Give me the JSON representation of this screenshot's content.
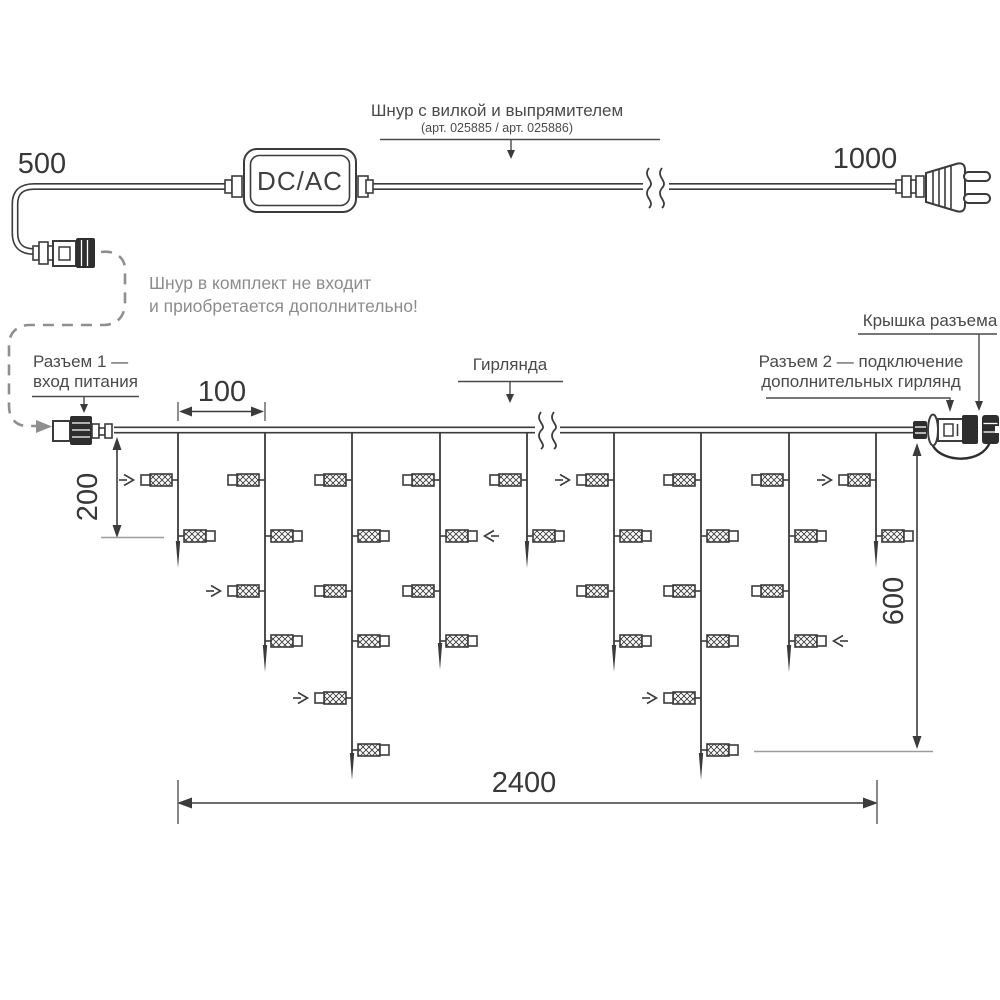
{
  "colors": {
    "ink": "#3b3b3b",
    "label_text": "#4a4a4a",
    "muted_text": "#8c8c8c",
    "dashed_line": "#8f8f8f",
    "reference_line": "#9c9c9c"
  },
  "power_cord": {
    "label_line1": "Шнур с вилкой и выпрямителем",
    "label_line2": "(арт. 025885 / арт. 025886)",
    "adapter_label": "DC/AC",
    "dim_left": "500",
    "dim_right": "1000",
    "note_line1": "Шнур в комплект не входит",
    "note_line2": "и приобретается дополнительно!"
  },
  "garland_labels": {
    "connector1_line1": "Разъем 1 —",
    "connector1_line2": "вход питания",
    "garland": "Гирлянда",
    "connector2_line1": "Разъем 2 — подключение",
    "connector2_line2": "дополнительных гирлянд",
    "cap": "Крышка разъема"
  },
  "dimensions": {
    "drop_spacing": "100",
    "first_drop": "200",
    "height": "600",
    "length": "2400"
  },
  "garland": {
    "wire_y": 430,
    "x_start": 114,
    "x_end": 915,
    "lamp_levels": [
      480,
      536,
      591,
      641,
      698,
      750
    ],
    "drops": [
      {
        "x": 178,
        "lamps": 2,
        "tip": 568,
        "arrow": {
          "level": 0,
          "side": "L"
        }
      },
      {
        "x": 265,
        "lamps": 4,
        "tip": 672,
        "arrow": {
          "level": 2,
          "side": "L"
        }
      },
      {
        "x": 352,
        "lamps": 6,
        "tip": 780,
        "arrow": {
          "level": 4,
          "side": "L"
        }
      },
      {
        "x": 440,
        "lamps": 4,
        "tip": 670,
        "arrow": {
          "level": 1,
          "side": "R"
        }
      },
      {
        "x": 527,
        "lamps": 2,
        "tip": 568,
        "arrow": null
      },
      {
        "x": 614,
        "lamps": 4,
        "tip": 672,
        "arrow": {
          "level": 0,
          "side": "L"
        }
      },
      {
        "x": 701,
        "lamps": 6,
        "tip": 780,
        "arrow": {
          "level": 4,
          "side": "L"
        }
      },
      {
        "x": 789,
        "lamps": 4,
        "tip": 672,
        "arrow": {
          "level": 3,
          "side": "R"
        }
      },
      {
        "x": 876,
        "lamps": 2,
        "tip": 568,
        "arrow": {
          "level": 0,
          "side": "L"
        }
      }
    ]
  }
}
